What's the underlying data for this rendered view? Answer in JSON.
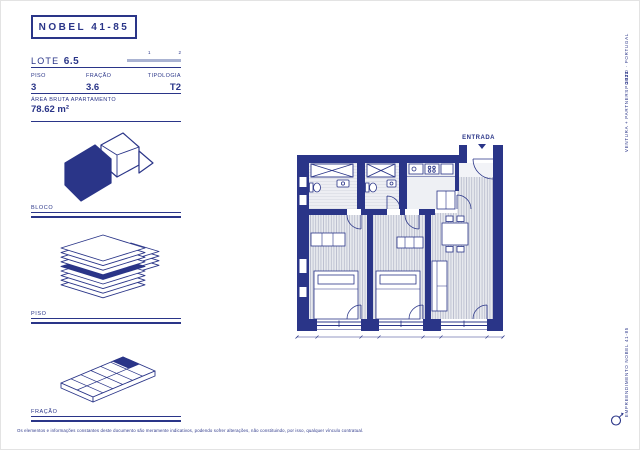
{
  "page": {
    "title": "NOBEL 41-85",
    "lote": {
      "label": "LOTE",
      "value": "6.5"
    },
    "pagination": {
      "page1": "1",
      "page2": "2"
    },
    "fields": [
      {
        "label": "PISO",
        "value": "3"
      },
      {
        "label": "FRAÇÃO",
        "value": "3.6"
      },
      {
        "label": "TIPOLOGIA",
        "value": "T2"
      }
    ],
    "area": {
      "label": "ÁREA BRUTA APARTAMENTO",
      "value": "78.62 m²"
    },
    "sections": [
      {
        "label": "BLOCO"
      },
      {
        "label": "PISO"
      },
      {
        "label": "FRAÇÃO"
      }
    ],
    "plan": {
      "entrance": "ENTRADA"
    },
    "margin_texts": {
      "location": "PORTO · PORTUGAL",
      "year": "2023",
      "brand": "VENTURA + PARTNERS",
      "footer": "EMPREENDIMENTO NOBEL 41-85"
    },
    "disclaimer": "Os elementos e informações constantes deste documento são meramente indicativos, podendo sofrer alterações, não constituindo, por isso, qualquer vínculo contratual.",
    "colors": {
      "navy": "#2a3588",
      "muted_bar": "#aab3d2",
      "floor_fill": "#e7e9ee",
      "floor_hatch": "#aeb3c6"
    }
  }
}
